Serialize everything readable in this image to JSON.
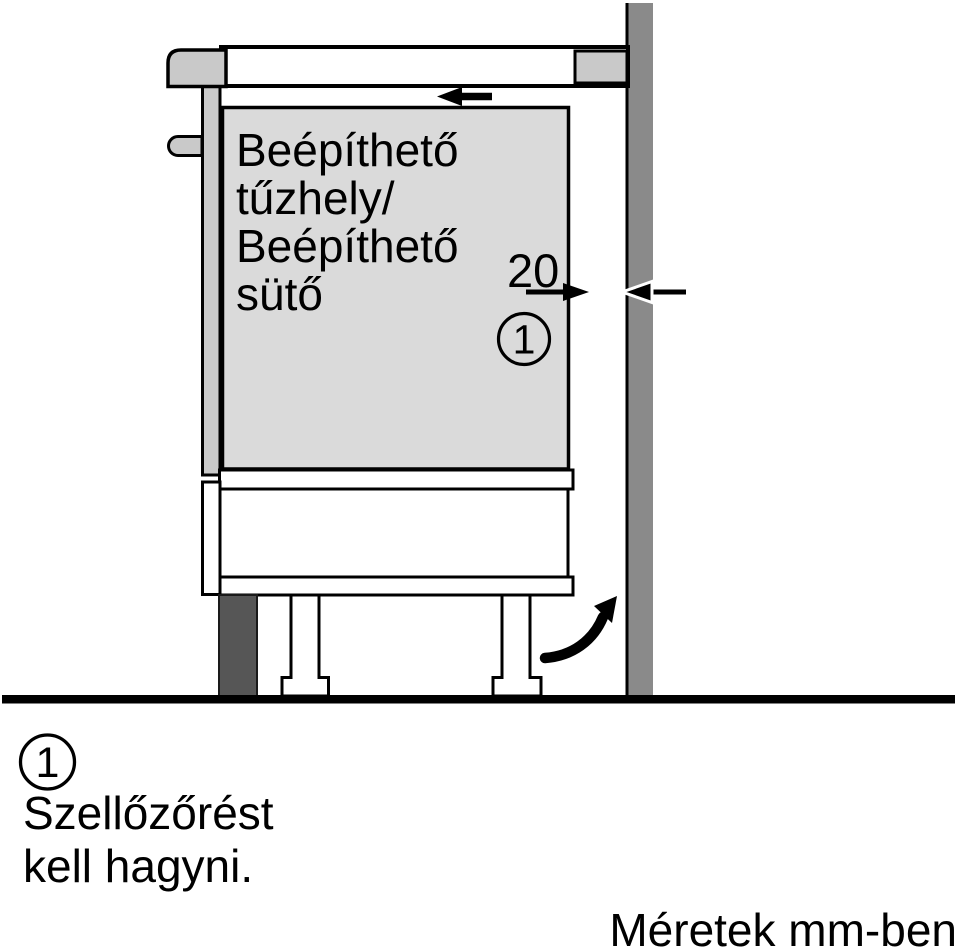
{
  "colors": {
    "wall": "#8a8a8a",
    "trim": "#c9c9c9",
    "appliance_fill": "#dadada",
    "cabinet_fill": "#ffffff",
    "plinth": "#565656",
    "line": "#000000",
    "background": "#ffffff"
  },
  "diagram": {
    "appliance_label": {
      "lines": [
        "Beépíthető",
        "tűzhely/",
        "Beépíthető",
        "sütő"
      ]
    },
    "gap_dimension": {
      "value": "20",
      "marker": "1"
    },
    "icons": {
      "insert_direction": "arrow-left-icon",
      "gap_arrows": "opposing-dimension-arrows-icon",
      "airflow": "curved-arrow-up-right-icon"
    }
  },
  "legend": {
    "marker": "1",
    "note_lines": [
      "Szellőzőrést",
      "kell hagyni."
    ]
  },
  "footer": {
    "units_note": "Méretek mm-ben"
  }
}
